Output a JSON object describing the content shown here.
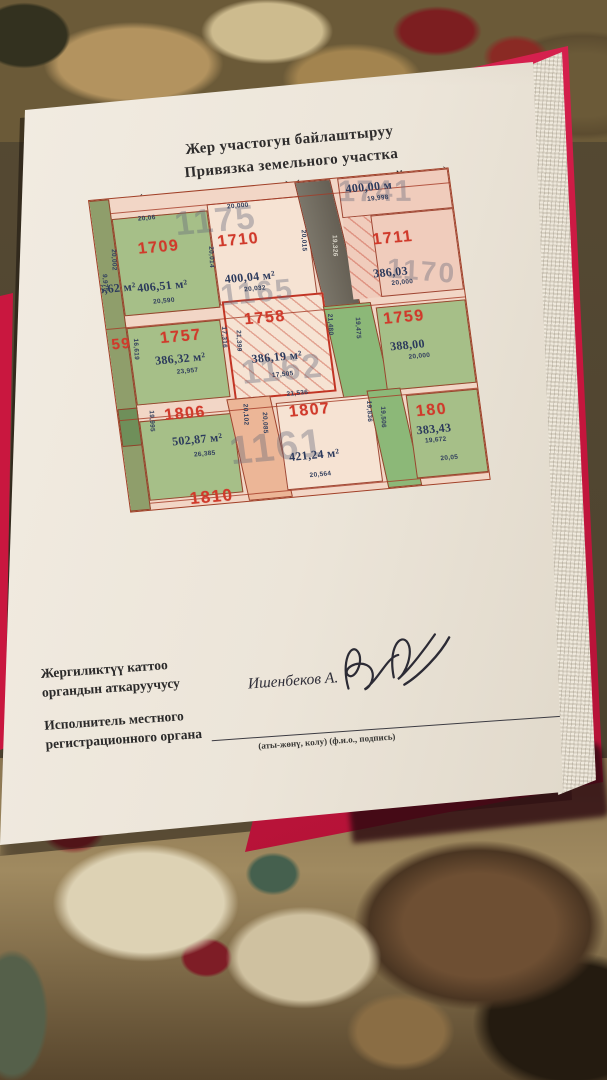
{
  "page": {
    "title_lines": [
      "Жер участогун байлаштыруу",
      "Привязка земельного участка",
      "(кырдаалдык планы) (ситуационный план)"
    ],
    "footer": {
      "executor_ky_line1": "Жергиликтүү каттоо",
      "executor_ky_line2": "органдын аткаруучусу",
      "executor_ru_line1": "Исполнитель местного",
      "executor_ru_line2": "регистрационного органа",
      "signer_name": "Ишенбеков А.",
      "signature_caption": "(аты-жөнү, колу)  (ф.и.о., подпись)"
    }
  },
  "map": {
    "parcels": [
      {
        "number": "1709",
        "area": "406,51 м²",
        "dim_top": "20,06",
        "dim_bottom": "20,590",
        "dim_left": "20,002",
        "dim_left2": "9,975"
      },
      {
        "number": "1710",
        "area": "400,04 м²",
        "dim_top": "20,000",
        "dim_bottom": "20,032",
        "dim_left": "20,014",
        "dim_right": "20,015"
      },
      {
        "number": "1711",
        "area": "386,03",
        "dim_bottom": "20,000"
      },
      {
        "number": "1757",
        "area": "386,32 м²",
        "dim_bottom": "23,957",
        "dim_left": "16,619",
        "dim_right": "17,316"
      },
      {
        "number": "1758",
        "area": "386,19 м²",
        "dim_bottom": "17,505",
        "dim_left": "21,399"
      },
      {
        "number": "1759",
        "area": "388,00",
        "dim_bottom": "20,000"
      },
      {
        "number": "1806",
        "area": "502,87 м²",
        "dim_bottom": "26,385",
        "dim_left": "19,995"
      },
      {
        "number": "1807",
        "area": "421,24 м²",
        "dim_top": "21,536",
        "dim_bottom": "20,564"
      },
      {
        "number": "180",
        "area": "383,43",
        "dim_mid": "19,672",
        "dim_bottom": "20,05"
      }
    ],
    "corner_parcel": {
      "area": "400,00 м",
      "dim": "19,998"
    },
    "road_dim": "19,326",
    "strip_dims": {
      "green_a1": "21,480",
      "green_a2": "19,475",
      "salmon1": "20,102",
      "salmon2": "20,085",
      "green_b1": "19,836",
      "green_b2": "19,506"
    },
    "partials": {
      "left_area": "6,62 м²",
      "left_number": "59",
      "bottom_number": "1810"
    },
    "faint_blocks": [
      "1175",
      "1741",
      "1165",
      "1162",
      "1170",
      "1161"
    ]
  },
  "colors": {
    "folder_red": "#c9173f",
    "parcel_number_red": "#d03a2b",
    "area_navy": "#2c3a5c",
    "map_bg": "#f2d6c6",
    "map_green": "#a6bf88",
    "map_cream": "#f6e3d3",
    "map_pink": "#f0ccbc",
    "road_gray": "#6f6a5e",
    "strip_green": "#8cb878",
    "salmon": "#ecb697"
  }
}
